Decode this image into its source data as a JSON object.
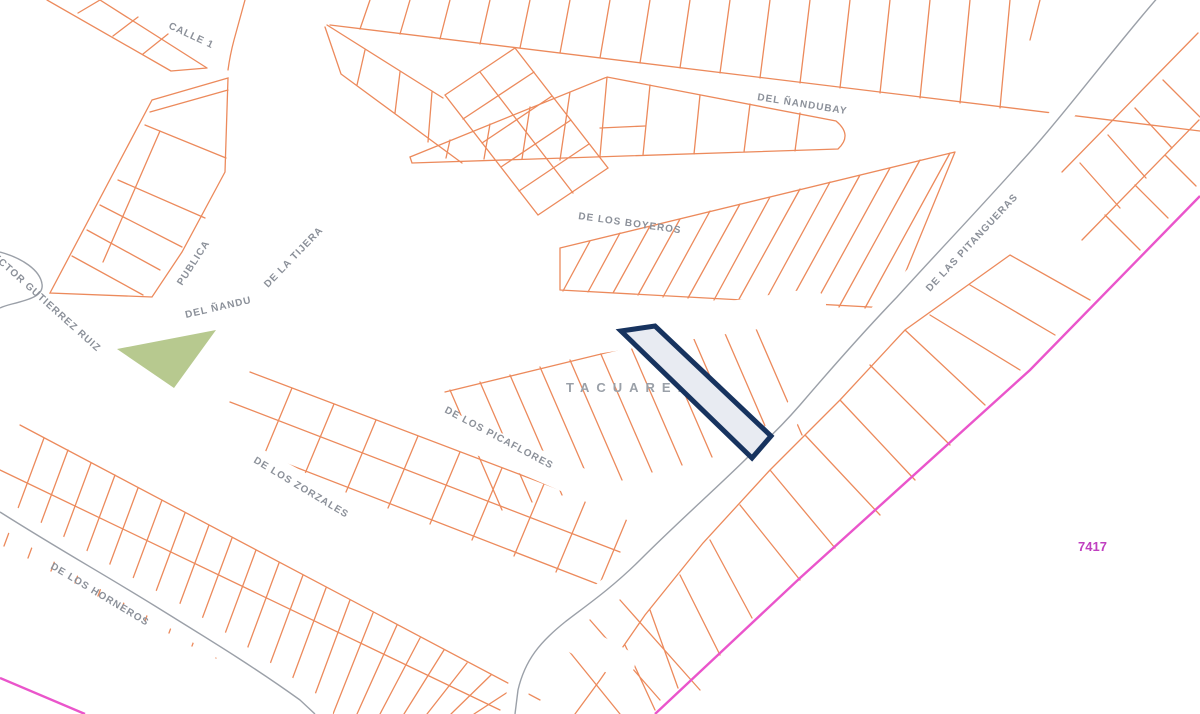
{
  "map": {
    "region_label": "TACUAREMBO",
    "parcel_ref": "7417",
    "streets": [
      {
        "name": "CALLE 1"
      },
      {
        "name": "DEL ÑANDUBAY"
      },
      {
        "name": "DE LOS BOYEROS"
      },
      {
        "name": "DE LA TIJERA"
      },
      {
        "name": "PUBLICA"
      },
      {
        "name": "DEL ÑANDU"
      },
      {
        "name": "HECTOR GUTIERREZ RUIZ"
      },
      {
        "name": "DE LOS PICAFLORES"
      },
      {
        "name": "DE LOS ZORZALES"
      },
      {
        "name": "DE LOS HORNEROS"
      },
      {
        "name": "DE LAS PITANGUERAS"
      }
    ],
    "colors": {
      "background": "#ffffff",
      "parcel_line": "#ec8a5c",
      "road_line": "#9ba0a8",
      "label_text": "#8b9099",
      "highlight_stroke": "#17335f",
      "highlight_fill": "#e8ebf2",
      "green_area": "#b7c98f",
      "boundary_magenta": "#ea55cb",
      "ref_text": "#c03fc0"
    }
  }
}
